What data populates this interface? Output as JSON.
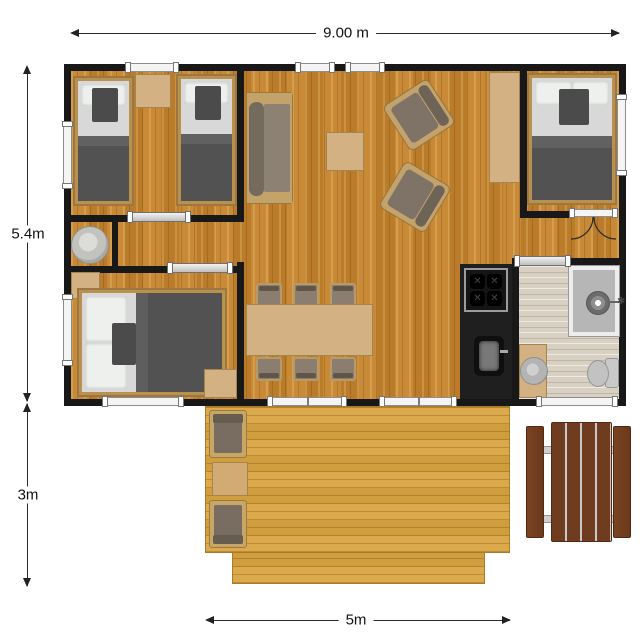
{
  "plan": {
    "type": "architectural-floor-plan",
    "dims": {
      "overall_width": "9.00 m",
      "house_depth": "5.4m",
      "deck_depth": "3m",
      "deck_width": "5m"
    }
  },
  "colors": {
    "wall": "#181818",
    "interior_floor": "#c6842c",
    "deck_floor": "#d9a440",
    "bathroom_floor": "#d8d0c3",
    "furniture_wood": "#d4b183",
    "upholstery": "#7e7366",
    "bedding_dark": "#525252",
    "bedding_light": "#d8d8d8",
    "kitchen_counter": "#1f1f1f",
    "picnic_wood": "#6f3c20",
    "background": "#ffffff"
  },
  "legend": {
    "rooms": [
      "twin-bedroom",
      "double-bedroom-left",
      "double-bedroom-right",
      "living-dining-area",
      "kitchen",
      "bathroom",
      "tech-closet",
      "hallway",
      "deck"
    ],
    "furniture": [
      "single-bed",
      "double-bed",
      "bedside-table",
      "sofa",
      "armchair",
      "coffee-table",
      "sideboard",
      "dining-table",
      "dining-chair",
      "stove",
      "kitchen-sink",
      "shower",
      "washbasin",
      "toilet",
      "water-heater",
      "deck-armchair",
      "deck-side-table",
      "picnic-table"
    ]
  }
}
